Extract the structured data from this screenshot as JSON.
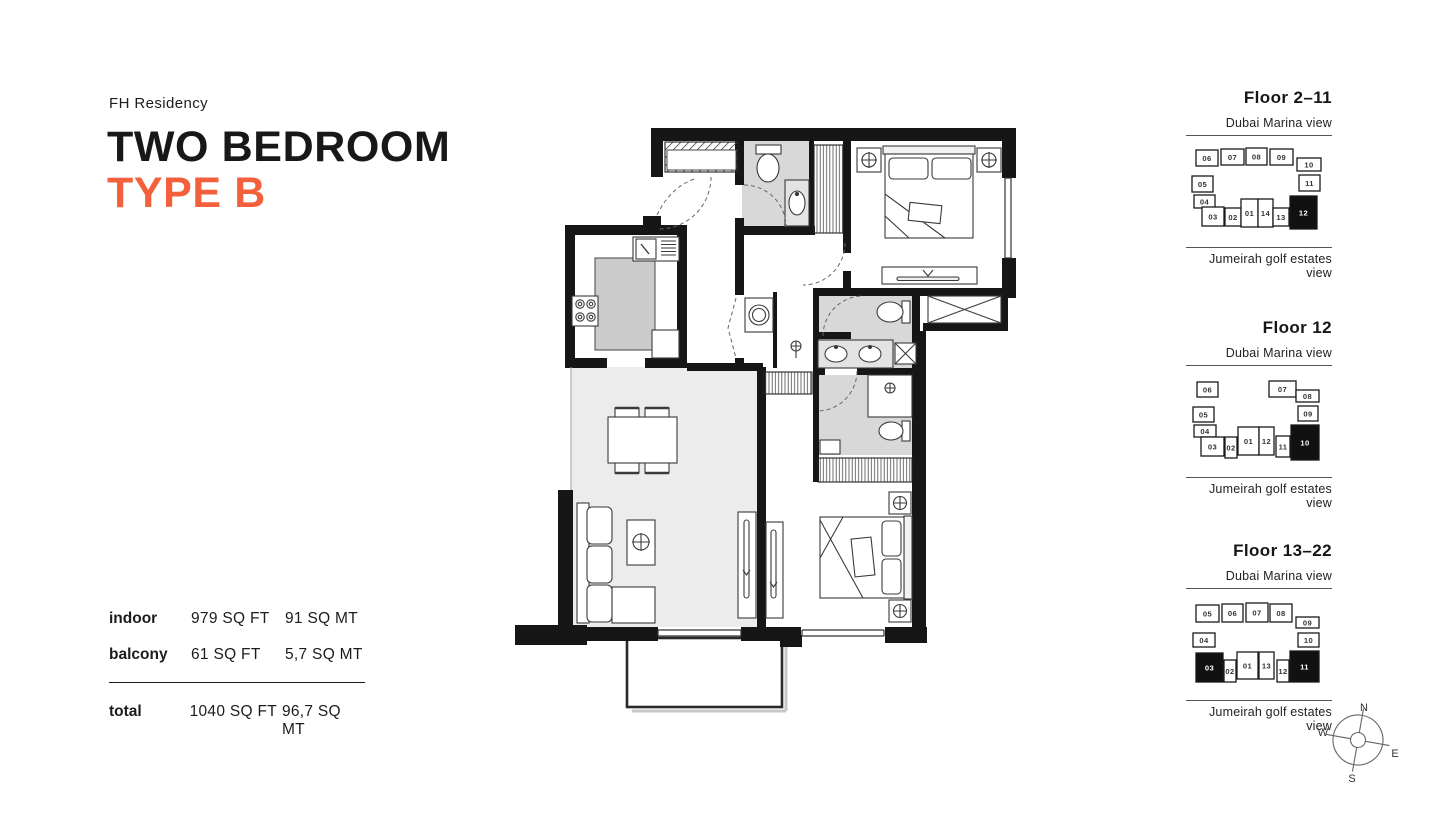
{
  "accent_color": "#F5603C",
  "wall_color": "#161616",
  "header": {
    "brand": "FH Residency",
    "title_line1": "TWO BEDROOM",
    "title_line2": "TYPE B"
  },
  "stats": {
    "rows": [
      {
        "label": "indoor",
        "sqft": "979 SQ FT",
        "sqmt": "91 SQ MT"
      },
      {
        "label": "balcony",
        "sqft": "61 SQ FT",
        "sqmt": "5,7 SQ MT"
      }
    ],
    "total": {
      "label": "total",
      "sqft": "1040 SQ FT",
      "sqmt": "96,7 SQ MT"
    }
  },
  "floors": [
    {
      "title": "Floor 2–11",
      "top_view": "Dubai Marina view",
      "bottom_view": "Jumeirah golf estates view",
      "units": [
        {
          "label": "06",
          "x": 10,
          "y": 11,
          "w": 22,
          "h": 16,
          "highlighted": false
        },
        {
          "label": "07",
          "x": 35,
          "y": 10,
          "w": 23,
          "h": 16,
          "highlighted": false
        },
        {
          "label": "08",
          "x": 60,
          "y": 9,
          "w": 21,
          "h": 17,
          "highlighted": false
        },
        {
          "label": "09",
          "x": 84,
          "y": 10,
          "w": 23,
          "h": 16,
          "highlighted": false
        },
        {
          "label": "10",
          "x": 111,
          "y": 19,
          "w": 24,
          "h": 13,
          "highlighted": false
        },
        {
          "label": "05",
          "x": 6,
          "y": 37,
          "w": 21,
          "h": 16,
          "highlighted": false
        },
        {
          "label": "11",
          "x": 113,
          "y": 36,
          "w": 21,
          "h": 16,
          "highlighted": false
        },
        {
          "label": "04",
          "x": 8,
          "y": 56,
          "w": 21,
          "h": 13,
          "highlighted": false
        },
        {
          "label": "03",
          "x": 16,
          "y": 68,
          "w": 22,
          "h": 19,
          "highlighted": false
        },
        {
          "label": "02",
          "x": 39,
          "y": 69,
          "w": 16,
          "h": 18,
          "highlighted": false
        },
        {
          "label": "01",
          "x": 55,
          "y": 60,
          "w": 17,
          "h": 28,
          "highlighted": false
        },
        {
          "label": "14",
          "x": 72,
          "y": 60,
          "w": 15,
          "h": 28,
          "highlighted": false
        },
        {
          "label": "13",
          "x": 87,
          "y": 69,
          "w": 16,
          "h": 18,
          "highlighted": false
        },
        {
          "label": "12",
          "x": 104,
          "y": 57,
          "w": 27,
          "h": 33,
          "highlighted": true
        }
      ]
    },
    {
      "title": "Floor 12",
      "top_view": "Dubai Marina view",
      "bottom_view": "Jumeirah golf estates view",
      "units": [
        {
          "label": "06",
          "x": 11,
          "y": 13,
          "w": 21,
          "h": 15,
          "highlighted": false
        },
        {
          "label": "07",
          "x": 83,
          "y": 12,
          "w": 27,
          "h": 16,
          "highlighted": false
        },
        {
          "label": "08",
          "x": 110,
          "y": 21,
          "w": 23,
          "h": 12,
          "highlighted": false
        },
        {
          "label": "05",
          "x": 7,
          "y": 38,
          "w": 21,
          "h": 15,
          "highlighted": false
        },
        {
          "label": "09",
          "x": 112,
          "y": 37,
          "w": 20,
          "h": 15,
          "highlighted": false
        },
        {
          "label": "04",
          "x": 8,
          "y": 56,
          "w": 22,
          "h": 12,
          "highlighted": false
        },
        {
          "label": "03",
          "x": 15,
          "y": 68,
          "w": 23,
          "h": 19,
          "highlighted": false
        },
        {
          "label": "02",
          "x": 39,
          "y": 68,
          "w": 12,
          "h": 21,
          "highlighted": false
        },
        {
          "label": "01",
          "x": 52,
          "y": 58,
          "w": 21,
          "h": 28,
          "highlighted": false
        },
        {
          "label": "12",
          "x": 73,
          "y": 58,
          "w": 15,
          "h": 28,
          "highlighted": false
        },
        {
          "label": "11",
          "x": 90,
          "y": 67,
          "w": 14,
          "h": 21,
          "highlighted": false
        },
        {
          "label": "10",
          "x": 105,
          "y": 56,
          "w": 28,
          "h": 35,
          "highlighted": true
        }
      ]
    },
    {
      "title": "Floor 13–22",
      "top_view": "Dubai Marina view",
      "bottom_view": "Jumeirah golf estates view",
      "units": [
        {
          "label": "05",
          "x": 10,
          "y": 13,
          "w": 23,
          "h": 17,
          "highlighted": false
        },
        {
          "label": "06",
          "x": 36,
          "y": 12,
          "w": 21,
          "h": 18,
          "highlighted": false
        },
        {
          "label": "07",
          "x": 60,
          "y": 11,
          "w": 22,
          "h": 19,
          "highlighted": false
        },
        {
          "label": "08",
          "x": 84,
          "y": 12,
          "w": 22,
          "h": 18,
          "highlighted": false
        },
        {
          "label": "09",
          "x": 110,
          "y": 25,
          "w": 23,
          "h": 11,
          "highlighted": false
        },
        {
          "label": "04",
          "x": 7,
          "y": 41,
          "w": 22,
          "h": 14,
          "highlighted": false
        },
        {
          "label": "10",
          "x": 112,
          "y": 41,
          "w": 21,
          "h": 14,
          "highlighted": false
        },
        {
          "label": "03",
          "x": 10,
          "y": 61,
          "w": 27,
          "h": 29,
          "highlighted": true
        },
        {
          "label": "02",
          "x": 38,
          "y": 68,
          "w": 12,
          "h": 22,
          "highlighted": false
        },
        {
          "label": "01",
          "x": 51,
          "y": 60,
          "w": 21,
          "h": 27,
          "highlighted": false
        },
        {
          "label": "13",
          "x": 73,
          "y": 60,
          "w": 15,
          "h": 27,
          "highlighted": false
        },
        {
          "label": "12",
          "x": 91,
          "y": 68,
          "w": 12,
          "h": 22,
          "highlighted": false
        },
        {
          "label": "11",
          "x": 104,
          "y": 59,
          "w": 29,
          "h": 31,
          "highlighted": true
        }
      ]
    }
  ],
  "compass": {
    "n": "N",
    "e": "E",
    "s": "S",
    "w": "W"
  }
}
